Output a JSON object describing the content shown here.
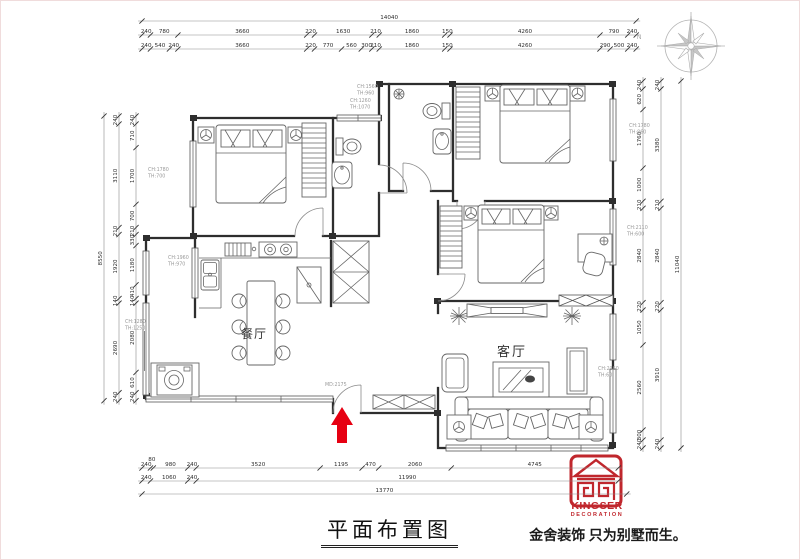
{
  "title": {
    "text": "平面布置图"
  },
  "branding": {
    "logo_top": "KINGSER",
    "logo_sub": "DECORATION",
    "tagline": "金舍装饰 只为别墅而生。"
  },
  "compass": {
    "label": "N"
  },
  "rooms": {
    "dining": "餐厅",
    "living": "客厅"
  },
  "colors": {
    "brand_red": "#c0272d",
    "arrow_red": "#e60012"
  },
  "dimension_rows": [
    {
      "dir": "h",
      "x": 141,
      "y": 20,
      "scale": 0.0352,
      "values": [
        14040
      ]
    },
    {
      "dir": "h",
      "x": 141,
      "y": 34,
      "scale": 0.0352,
      "values": [
        240,
        780,
        3660,
        220,
        1630,
        210,
        1860,
        150,
        4260,
        790,
        240
      ]
    },
    {
      "dir": "h",
      "x": 141,
      "y": 48,
      "scale": 0.0352,
      "values": [
        240,
        540,
        240,
        3660,
        220,
        770,
        560,
        300,
        210,
        1860,
        150,
        4260,
        290,
        500,
        240
      ]
    },
    {
      "dir": "h",
      "x": 141,
      "y": 467,
      "scale": 0.0352,
      "values": [
        240,
        80,
        980,
        240,
        3520,
        1195,
        470,
        2060,
        4745
      ]
    },
    {
      "dir": "h",
      "x": 141,
      "y": 480,
      "scale": 0.0352,
      "values": [
        240,
        1060,
        240,
        11990
      ]
    },
    {
      "dir": "h",
      "x": 141,
      "y": 493,
      "scale": 0.0352,
      "values": [
        13770
      ]
    },
    {
      "dir": "v",
      "x": 103,
      "y": 115,
      "scale": 0.0333,
      "values": [
        8550
      ]
    },
    {
      "dir": "v",
      "x": 118,
      "y": 115,
      "scale": 0.0333,
      "values": [
        240,
        3110,
        210,
        1920,
        140,
        2690,
        240
      ]
    },
    {
      "dir": "v",
      "x": 135,
      "y": 115,
      "scale": 0.0333,
      "values": [
        240,
        710,
        1700,
        700,
        210,
        330,
        1180,
        410,
        140,
        2080,
        610,
        240
      ]
    },
    {
      "dir": "v",
      "x": 680,
      "y": 80,
      "scale": 0.03324,
      "values": [
        11040
      ]
    },
    {
      "dir": "v",
      "x": 660,
      "y": 80,
      "scale": 0.03324,
      "values": [
        240,
        3380,
        210,
        2840,
        220,
        3910,
        240
      ]
    },
    {
      "dir": "v",
      "x": 642,
      "y": 80,
      "scale": 0.03324,
      "values": [
        240,
        620,
        1760,
        1000,
        210,
        2840,
        220,
        1050,
        2560,
        300,
        240
      ]
    }
  ],
  "annotations": [
    {
      "x": 147,
      "y": 170,
      "lines": [
        "CH:1780",
        "TH:700"
      ]
    },
    {
      "x": 167,
      "y": 258,
      "lines": [
        "CH:1960",
        "TH:970"
      ]
    },
    {
      "x": 124,
      "y": 322,
      "lines": [
        "CH:1280",
        "TH:1250"
      ]
    },
    {
      "x": 356,
      "y": 87,
      "lines": [
        "CH:1560",
        "TH:960"
      ]
    },
    {
      "x": 349,
      "y": 101,
      "lines": [
        "CH:1260",
        "TH:1070"
      ]
    },
    {
      "x": 628,
      "y": 126,
      "lines": [
        "CH:1780",
        "TH:860"
      ]
    },
    {
      "x": 626,
      "y": 228,
      "lines": [
        "CH:2110",
        "TH:600"
      ]
    },
    {
      "x": 597,
      "y": 369,
      "lines": [
        "CH:2360",
        "TH:60"
      ]
    },
    {
      "x": 324,
      "y": 385,
      "lines": [
        "MD:2175"
      ]
    }
  ]
}
